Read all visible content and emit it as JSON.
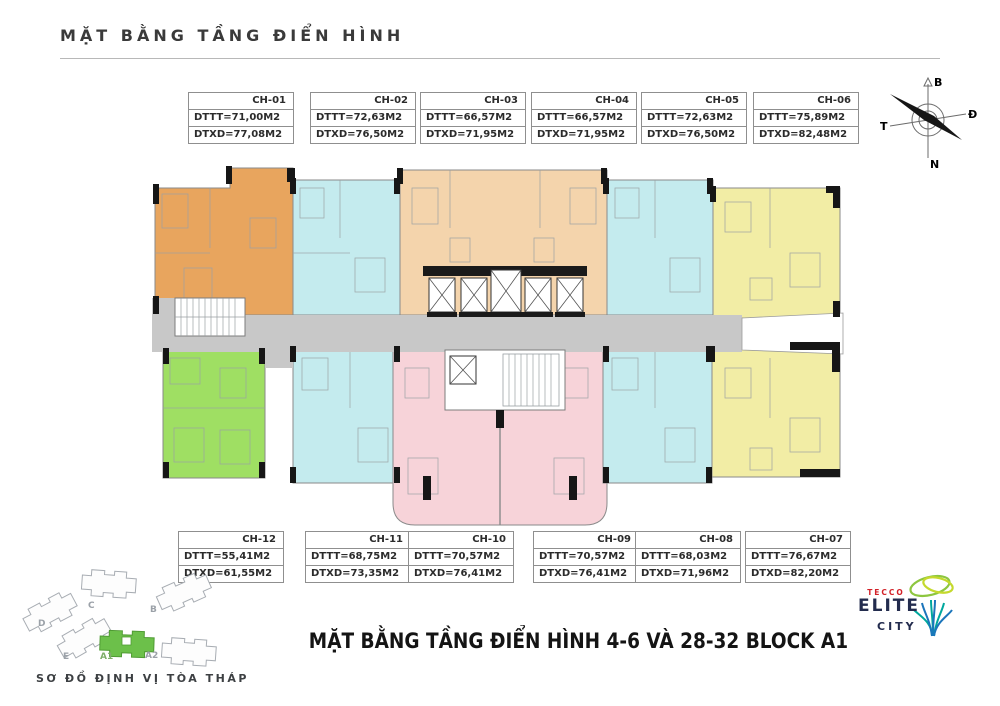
{
  "header": {
    "title": "MẶT BẰNG TẦNG ĐIỂN HÌNH"
  },
  "compass": {
    "north": "B",
    "east": "Đ",
    "south": "N",
    "west": "T"
  },
  "units_top": [
    {
      "id": "CH-01",
      "dttt": "DTTT=71,00M2",
      "dtxd": "DTXD=77,08M2"
    },
    {
      "id": "CH-02",
      "dttt": "DTTT=72,63M2",
      "dtxd": "DTXD=76,50M2"
    },
    {
      "id": "CH-03",
      "dttt": "DTTT=66,57M2",
      "dtxd": "DTXD=71,95M2"
    },
    {
      "id": "CH-04",
      "dttt": "DTTT=66,57M2",
      "dtxd": "DTXD=71,95M2"
    },
    {
      "id": "CH-05",
      "dttt": "DTTT=72,63M2",
      "dtxd": "DTXD=76,50M2"
    },
    {
      "id": "CH-06",
      "dttt": "DTTT=75,89M2",
      "dtxd": "DTXD=82,48M2"
    }
  ],
  "units_bottom": [
    {
      "id": "CH-12",
      "dttt": "DTTT=55,41M2",
      "dtxd": "DTXD=61,55M2"
    },
    {
      "id": "CH-11",
      "dttt": "DTTT=68,75M2",
      "dtxd": "DTXD=73,35M2"
    },
    {
      "id": "CH-10",
      "dttt": "DTTT=70,57M2",
      "dtxd": "DTXD=76,41M2"
    },
    {
      "id": "CH-09",
      "dttt": "DTTT=70,57M2",
      "dtxd": "DTXD=76,41M2"
    },
    {
      "id": "CH-08",
      "dttt": "DTTT=68,03M2",
      "dtxd": "DTXD=71,96M2"
    },
    {
      "id": "CH-07",
      "dttt": "DTTT=76,67M2",
      "dtxd": "DTXD=82,20M2"
    }
  ],
  "footer": {
    "title": "MẶT BẰNG TẦNG ĐIỂN HÌNH 4-6 VÀ 28-32 BLOCK A1"
  },
  "site_map": {
    "caption": "SƠ ĐỒ ĐỊNH VỊ TÒA THÁP",
    "labels": {
      "d": "D",
      "c": "C",
      "b": "B",
      "e": "E",
      "a1": "A1",
      "a2": "A2"
    },
    "highlighted_block": "A1"
  },
  "logo": {
    "brand": "TECCO",
    "name_line1": "ELITE",
    "name_line2": "CITY"
  },
  "colors": {
    "orange": "#e8a55e",
    "peach": "#f4d4ac",
    "cyan": "#c4ebee",
    "yellow": "#f2eda5",
    "green": "#9fdf63",
    "pink": "#f7d3d9",
    "corridor": "#c8c8c8",
    "site_highlight": "#6cc04a",
    "brand_red": "#d22027",
    "brand_navy": "#232c4e"
  }
}
